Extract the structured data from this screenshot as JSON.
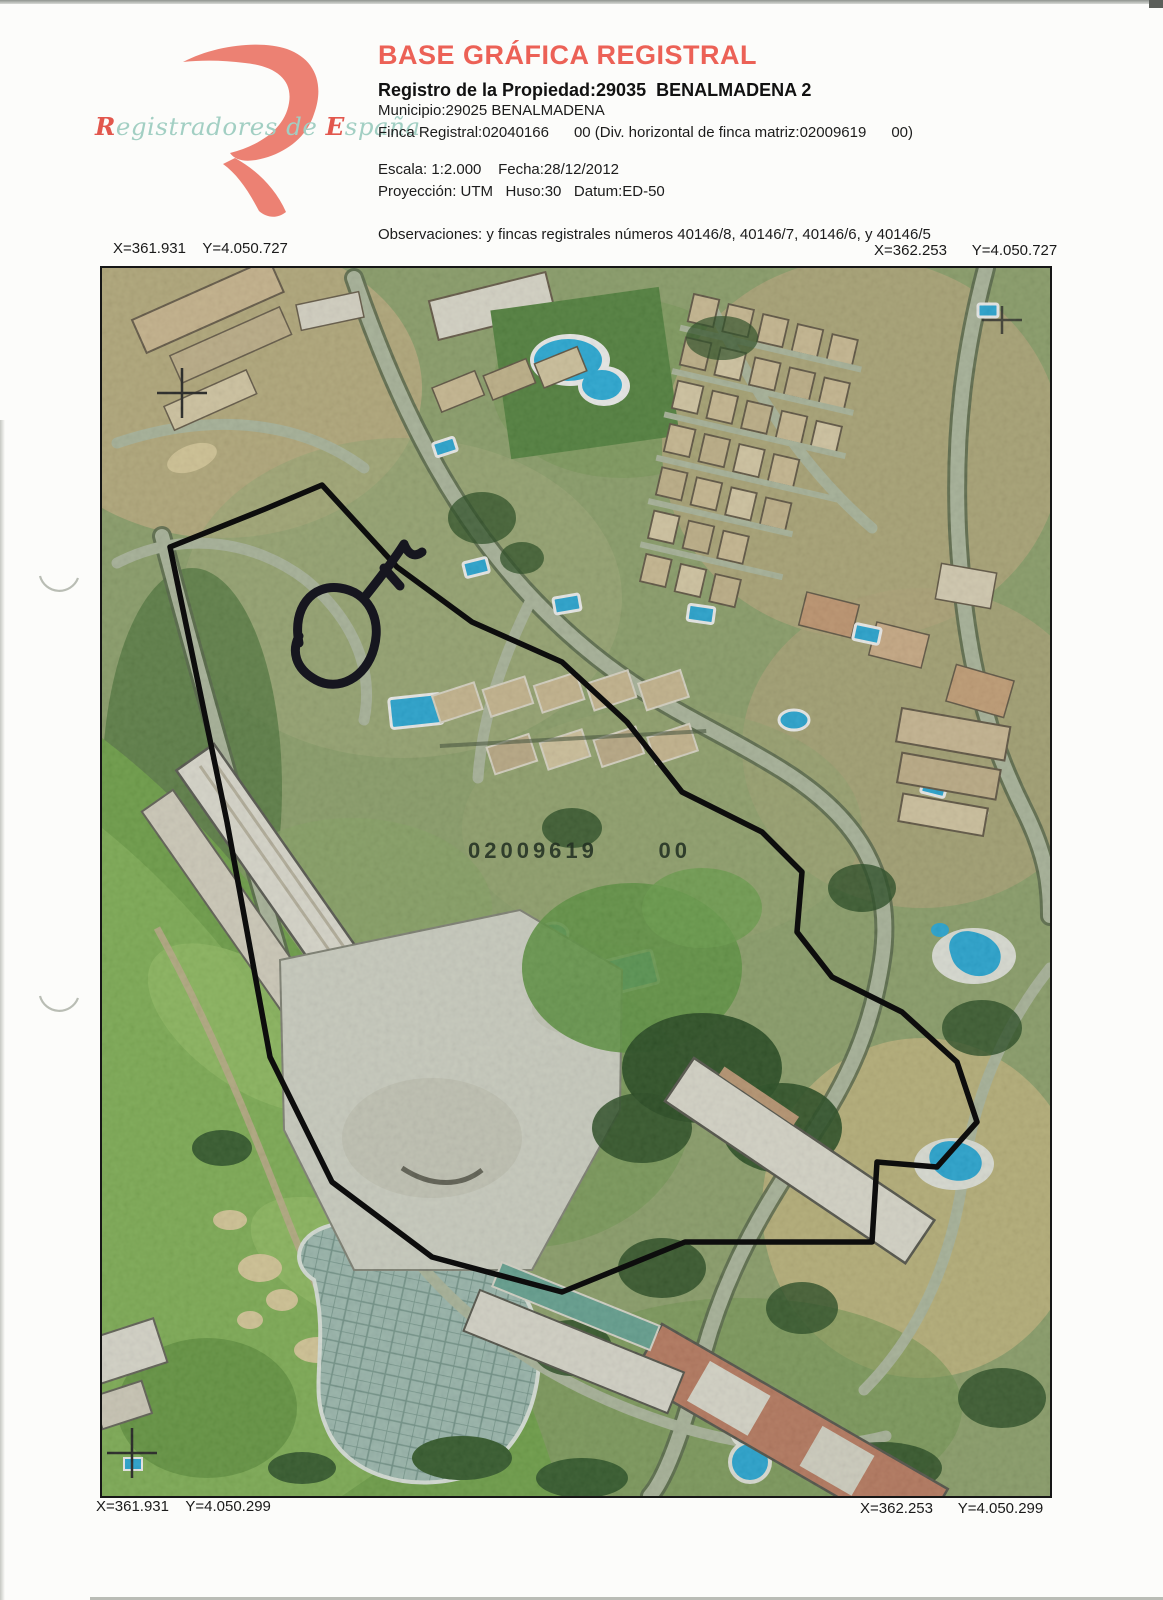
{
  "logo": {
    "brand_r": "R",
    "brand_mid": "egistradores de ",
    "brand_e": "E",
    "brand_end": "spaña"
  },
  "header": {
    "title": "BASE GRÁFICA REGISTRAL",
    "property_line": "Registro de la Propiedad:29035  BENALMADENA 2",
    "municipality_line": "Municipio:29025 BENALMADENA",
    "finca_line": "Finca Registral:02040166      00 (Div. horizontal de finca matriz:02009619      00)",
    "scale_line": "Escala: 1:2.000    Fecha:28/12/2012",
    "projection_line": "Proyección: UTM   Huso:30   Datum:ED-50",
    "observations_line": "Observaciones: y fincas registrales números 40146/8, 40146/7, 40146/6, y 40146/5"
  },
  "map": {
    "corner_coords": {
      "top_left": "X=361.931    Y=4.050.727",
      "top_right": "X=362.253      Y=4.050.727",
      "bottom_left": "X=361.931    Y=4.050.299",
      "bottom_right": "X=362.253      Y=4.050.299"
    },
    "overlay_label": "02009619      00",
    "scale_value": "1:2.000",
    "date_value": "28/12/2012",
    "finca_registral": "02040166",
    "finca_matriz": "02009619"
  },
  "colors": {
    "title_red": "#ec6156",
    "logo_red": "#ec8173",
    "logo_teal": "#a2cfc3",
    "pool_blue": "#2fb3e3",
    "boundary_black": "#0d0d0d",
    "vegetation_green": "#9aae78"
  }
}
